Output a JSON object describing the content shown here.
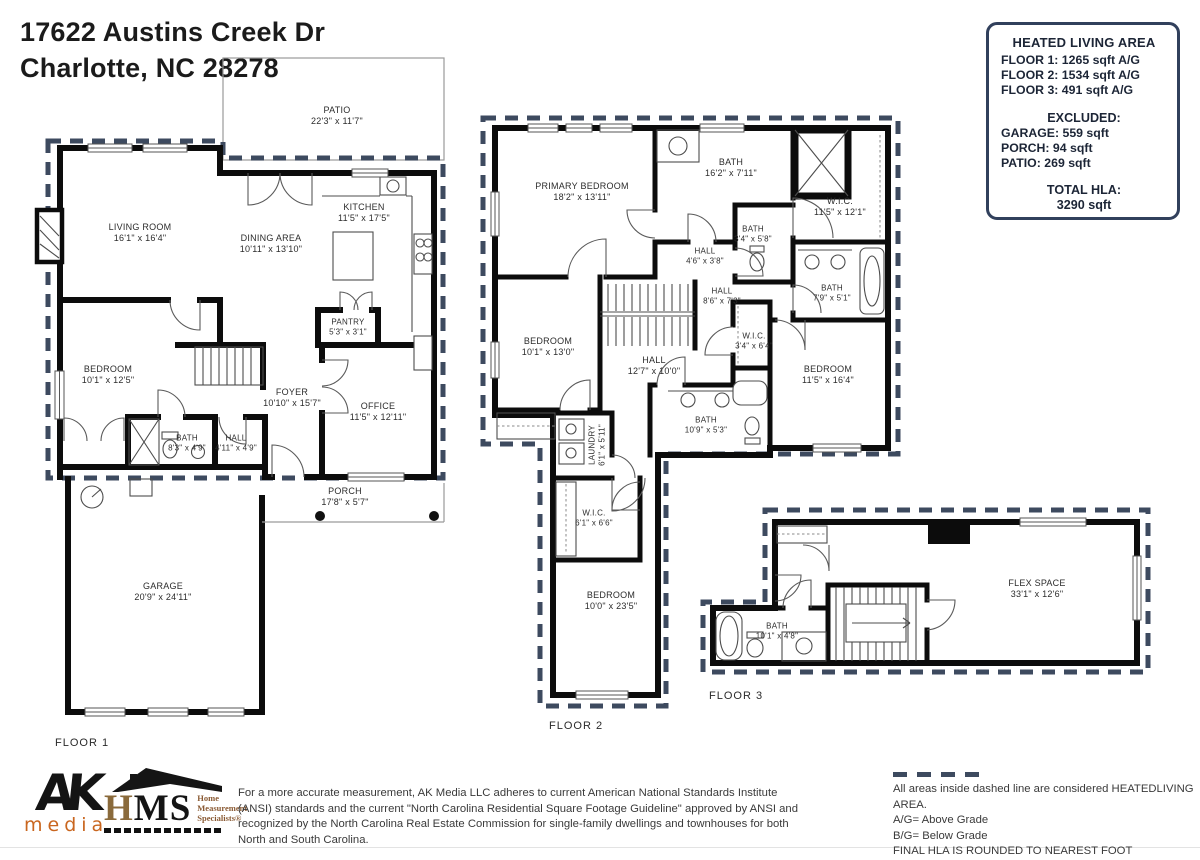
{
  "header": {
    "address_line1": "17622 Austins Creek Dr",
    "address_line2": "Charlotte, NC  28278"
  },
  "hla_box": {
    "title": "HEATED LIVING AREA",
    "floor1": "FLOOR 1: 1265 sqft A/G",
    "floor2": "FLOOR 2: 1534 sqft  A/G",
    "floor3": "FLOOR 3: 491 sqft  A/G",
    "excluded_title": "EXCLUDED:",
    "garage": "GARAGE: 559 sqft",
    "porch": "PORCH: 94 sqft",
    "patio": "PATIO: 269 sqft",
    "total_title": "TOTAL HLA:",
    "total_value": "3290 sqft"
  },
  "floors": [
    {
      "label": "FLOOR 1",
      "rooms": [
        {
          "name": "PATIO",
          "dims": "22'3\" x 11'7\""
        },
        {
          "name": "LIVING ROOM",
          "dims": "16'1\" x 16'4\""
        },
        {
          "name": "DINING AREA",
          "dims": "10'11\" x 13'10\""
        },
        {
          "name": "KITCHEN",
          "dims": "11'5\" x 17'5\""
        },
        {
          "name": "PANTRY",
          "dims": "5'3\" x 3'1\""
        },
        {
          "name": "BEDROOM",
          "dims": "10'1\" x 12'5\""
        },
        {
          "name": "FOYER",
          "dims": "10'10\" x 15'7\""
        },
        {
          "name": "OFFICE",
          "dims": "11'5\" x 12'11\""
        },
        {
          "name": "BATH",
          "dims": "8'3\" x 4'9\""
        },
        {
          "name": "HALL",
          "dims": "4'11\" x 4'9\""
        },
        {
          "name": "PORCH",
          "dims": "17'8\" x 5'7\""
        },
        {
          "name": "GARAGE",
          "dims": "20'9\" x 24'11\""
        }
      ]
    },
    {
      "label": "FLOOR 2",
      "rooms": [
        {
          "name": "PRIMARY BEDROOM",
          "dims": "18'2\" x 13'11\""
        },
        {
          "name": "BATH",
          "dims": "16'2\" x 7'11\""
        },
        {
          "name": "W.I.C.",
          "dims": "11'5\" x 12'1\""
        },
        {
          "name": "BATH",
          "dims": "3'4\" x 5'8\""
        },
        {
          "name": "HALL",
          "dims": "4'6\" x 3'8\""
        },
        {
          "name": "HALL",
          "dims": "8'6\" x 7'3\""
        },
        {
          "name": "BATH",
          "dims": "7'9\" x 5'1\""
        },
        {
          "name": "BEDROOM",
          "dims": "10'1\" x 13'0\""
        },
        {
          "name": "HALL",
          "dims": "12'7\" x 10'0\""
        },
        {
          "name": "W.I.C.",
          "dims": "3'4\" x 6'4\""
        },
        {
          "name": "BEDROOM",
          "dims": "11'5\" x 16'4\""
        },
        {
          "name": "BATH",
          "dims": "10'9\" x 5'3\""
        },
        {
          "name": "LAUNDRY",
          "dims": "6'1\" x 5'11\""
        },
        {
          "name": "W.I.C.",
          "dims": "6'1\" x 6'6\""
        },
        {
          "name": "BEDROOM",
          "dims": "10'0\" x 23'5\""
        }
      ]
    },
    {
      "label": "FLOOR 3",
      "rooms": [
        {
          "name": "FLEX SPACE",
          "dims": "33'1\" x 12'6\""
        },
        {
          "name": "BATH",
          "dims": "10'1\" x 4'8\""
        }
      ]
    }
  ],
  "footer": {
    "ak_logo_top": "AK",
    "ak_logo_bottom": "media",
    "hms_h": "H",
    "hms_ms": "MS",
    "hms_sub1": "Home",
    "hms_sub2": "Measurement",
    "hms_sub3": "Specialists®",
    "disclaimer": "For a more accurate measurement, AK Media LLC adheres to current American National Standards Institute (ANSI) standards and the current \"North Carolina Residential Square Footage Guideline\" approved by ANSI and recognized by the North Carolina Real Estate Commission for single-family dwellings and townhouses for both North and South Carolina.",
    "legend_line1": "All areas inside dashed line are considered HEATEDLIVING AREA.",
    "legend_line2": "A/G= Above Grade",
    "legend_line3": "B/G= Below Grade",
    "legend_line4": "FINAL HLA IS ROUNDED TO NEAREST FOOT"
  },
  "colors": {
    "dash": "#3d4a5f",
    "wall": "#0c0c0c",
    "ak_orange": "#c9661f",
    "hms_brown": "#8a6a3b"
  }
}
